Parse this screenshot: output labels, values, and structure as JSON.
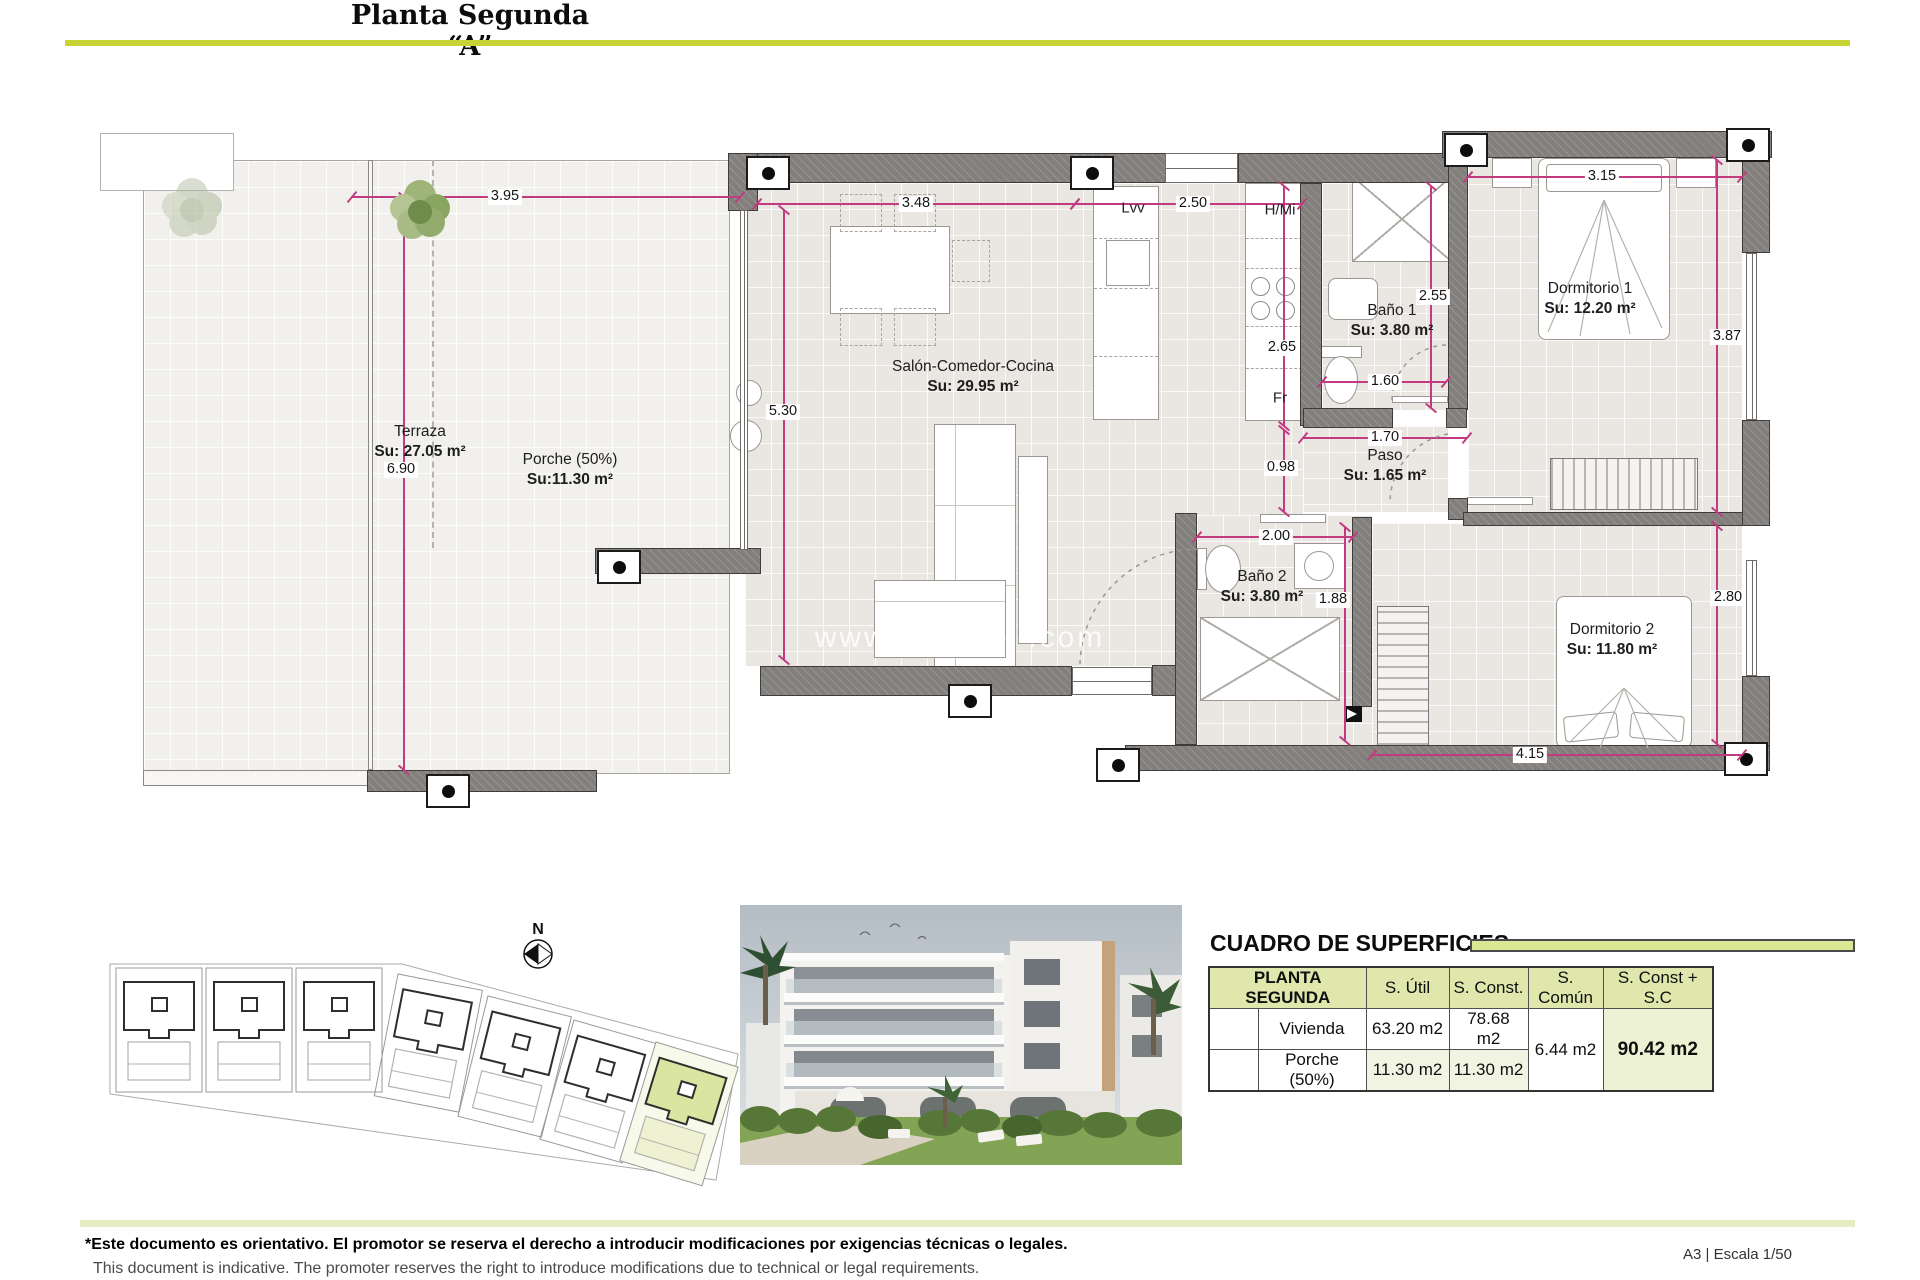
{
  "header": {
    "title": "Planta Segunda “A”"
  },
  "plan": {
    "watermark": "www.··········.com",
    "compass": "N",
    "rooms": {
      "terraza": {
        "name": "Terraza",
        "area": "Su: 27.05 m²"
      },
      "porche": {
        "name": "Porche (50%)",
        "area": "Su:11.30 m²"
      },
      "salon": {
        "name": "Salón-Comedor-Cocina",
        "area": "Su: 29.95 m²"
      },
      "bano1": {
        "name": "Baño 1",
        "area": "Su: 3.80 m²"
      },
      "paso": {
        "name": "Paso",
        "area": "Su: 1.65 m²"
      },
      "dorm1": {
        "name": "Dormitorio 1",
        "area": "Su: 12.20 m²"
      },
      "bano2": {
        "name": "Baño 2",
        "area": "Su: 3.80 m²"
      },
      "dorm2": {
        "name": "Dormitorio 2",
        "area": "Su: 11.80 m²"
      }
    },
    "appliances": {
      "dishwasher": "Lvv",
      "oven_micro": "H/Mi",
      "fridge": "Fr"
    },
    "dims": {
      "terraza_width": "3.95",
      "terraza_height": "6.90",
      "salon_width": "3.48",
      "salon_height": "5.30",
      "kitchen_width": "2.50",
      "kitchen_height": "2.65",
      "kitchen_lower": "0.98",
      "bano1_height": "2.55",
      "bano1_width": "1.60",
      "paso_width": "1.70",
      "dorm1_width": "3.15",
      "dorm1_height": "3.87",
      "bano2_width": "2.00",
      "bano2_height": "1.88",
      "dorm2_width": "4.15",
      "dorm2_height": "2.80"
    }
  },
  "surfaces": {
    "heading": "CUADRO DE SUPERFICIES",
    "table": {
      "header": [
        "PLANTA SEGUNDA",
        "S. Útil",
        "S. Const.",
        "S. Común",
        "S. Const + S.C"
      ],
      "rows": [
        {
          "label": "Vivienda",
          "util": "63.20 m2",
          "construida": "78.68 m2"
        },
        {
          "label": "Porche (50%)",
          "util": "11.30 m2",
          "construida": "11.30 m2"
        }
      ],
      "comun": "6.44 m2",
      "total": "90.42 m2"
    }
  },
  "footer": {
    "disclaimer_es": "*Este documento es orientativo. El promotor se reserva el derecho a introducir modificaciones por exigencias técnicas o legales.",
    "disclaimer_en": "This document is indicative. The promoter reserves the right to introduce modifications due to technical or legal requirements.",
    "sheet_info": "A3 | Escala 1/50"
  }
}
